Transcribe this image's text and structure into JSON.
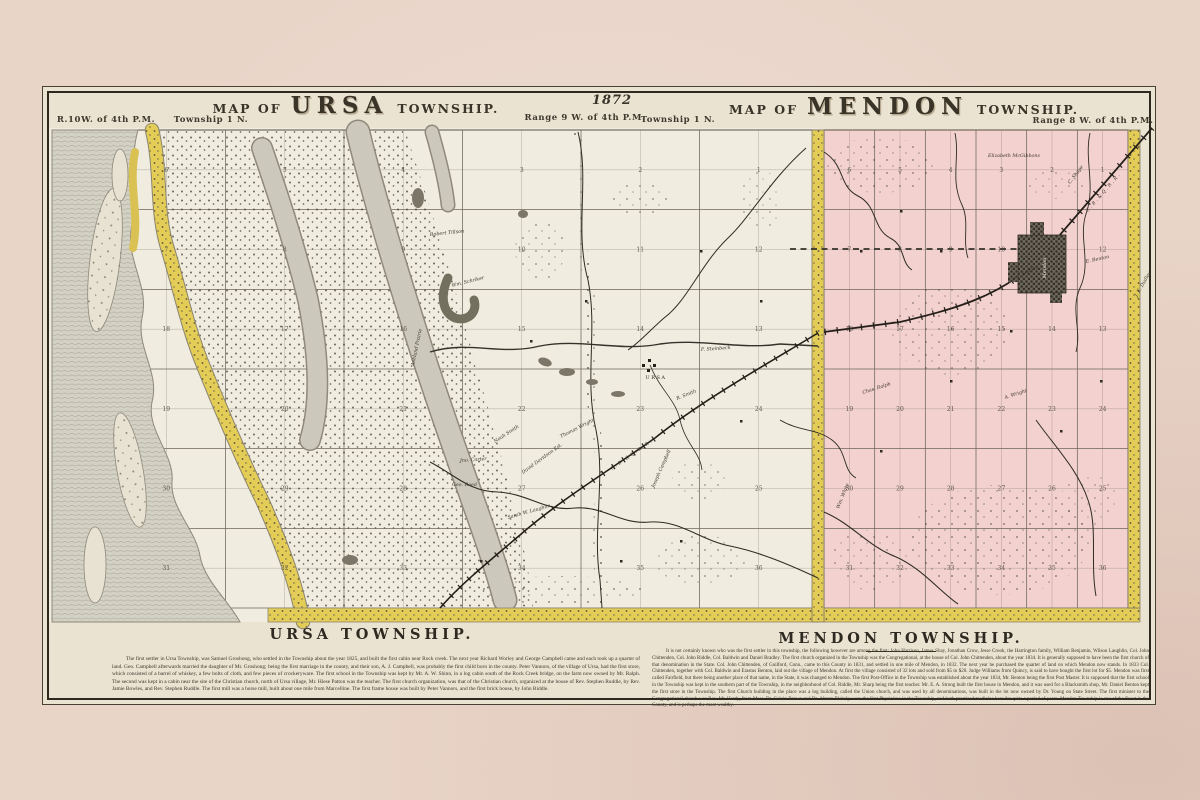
{
  "sheet": {
    "year": "1872",
    "ursa": {
      "map_title_prefix": "MAP OF",
      "map_title_name": "URSA",
      "map_title_suffix": "TOWNSHIP.",
      "meridian_label": "R.10W. of 4th P.M.",
      "township_label": "Township 1 N.",
      "range_label": "Range 9 W. of 4th P.M.",
      "footer_title": "URSA TOWNSHIP.",
      "history": "The first settler in Ursa Township, was Samuel Groshong, who settled in the Township about the year 1825, and built the first cabin near Rock creek. The next year Richard Worley and George Campbell came and each took up a quarter of land. Geo. Campbell afterwards married the daughter of Mr. Groshong; being the first marriage in the county, and their son, A. J. Campbell, was probably the first child born in the county. Peter Vannors, of the village of Ursa, had the first store, which consisted of a barrel of whiskey, a few bolts of cloth, and few pieces of crockeryware. The first school in the Township was kept by Mr. A. W. Shinn, in a log cabin south of the Rock Creek bridge, on the farm now owned by Mr. Ralph. The second was kept in a cabin near the site of the Christian church, north of Ursa village, Mr. Hiese Patton was the teacher. The first church organization, was that of the Christian church, organized at the house of Rev. Stephen Ruddle, by Rev. Jamie Bowles, and Rev. Stephen Ruddle. The first mill was a horse mill, built about one mile from Marcelline. The first frame house was built by Peter Vannors, and the first brick house, by John Riddle."
    },
    "mendon": {
      "map_title_prefix": "MAP OF",
      "map_title_name": "MENDON",
      "map_title_suffix": "TOWNSHIP.",
      "township_label": "Township 1 N.",
      "range_label": "Range 8 W. of 4th P.M.",
      "footer_title": "MENDON TOWNSHIP.",
      "history": "It is not certainly known who was the first settler in this township, the following however are among the first: John Harrison, James Shay, Jonathan Crow, Jesse Crook, the Harrington family, William Benjamin, Wilson Laughlin, Col. John Chittenden, Col. John Riddle, Col. Baldwin and Daniel Bradley. The first church organized in the Township was the Congregational, at the house of Col. John Chittenden, about the year 1834. It is generally supposed to have been the first church of that denomination in the State. Col. John Chittenden, of Guilford, Conn., came to this County in 1831, and settled in one mile of Mendon, in 1832. The next year he purchased the quarter of land on which Mendon now stands. In 1833 Col. Chittenden, together with Col. Baldwin and Erastus Benton, laid out the village of Mendon. At first the village consisted of 32 lots and sold from $5 to $20. Judge Williams from Quincy, is said to have bought the first lot for $5. Mendon was first called Fairfield, but there being another place of that name, in the State, it was changed to Mendon. The first Post-Office in the Township was established about the year 1834, Mr. Benton being the first Post Master. It is supposed that the first school in the Township was kept in the southern part of the Township, in the neighborhood of Col. Riddle, Mr. Sharp being the first teacher. Mr. E. A. Strong built the first house in Mendon, and it was used for a Blacksmith shop, Mr. Daniel Benton kept the first store in the Township. The first Church building in the place was a log building, called the Union church, and was used by all denominations, was built in the lot now owned by Dr. Young on State Street. The first minister to the Congregational church was Rev. Mr. Hardy, from Mass. Dr. Calvin Brown and Dr. Abram Blakely were the first Physicians in the Township, and both practiced medicine here for quite a period of years. Mendon Township is one of the finest in the County, and is perhaps the most wealthy."
    }
  },
  "map": {
    "ursa_sections": [
      "6",
      "5",
      "4",
      "3",
      "2",
      "1",
      "7",
      "8",
      "9",
      "10",
      "11",
      "12",
      "18",
      "17",
      "16",
      "15",
      "14",
      "13",
      "19",
      "20",
      "21",
      "22",
      "23",
      "24",
      "30",
      "29",
      "28",
      "27",
      "26",
      "25",
      "31",
      "32",
      "33",
      "34",
      "35",
      "36"
    ],
    "mendon_sections": [
      "6",
      "5",
      "4",
      "3",
      "2",
      "1",
      "7",
      "8",
      "9",
      "10",
      "11",
      "12",
      "18",
      "17",
      "16",
      "15",
      "14",
      "13",
      "19",
      "20",
      "21",
      "22",
      "23",
      "24",
      "30",
      "29",
      "28",
      "27",
      "26",
      "25",
      "31",
      "32",
      "33",
      "34",
      "35",
      "36"
    ],
    "ursa_labels": [
      {
        "t": "Robert Tillson",
        "x": 430,
        "y": 236,
        "r": -6
      },
      {
        "t": "Wm. Schriker",
        "x": 452,
        "y": 287,
        "r": -14
      },
      {
        "t": "Ashland Prairie",
        "x": 414,
        "y": 366,
        "r": -78,
        "s": 5.2
      },
      {
        "t": "Noah Smith",
        "x": 495,
        "y": 443,
        "r": -33
      },
      {
        "t": "Thomas Wright",
        "x": 561,
        "y": 438,
        "r": -27
      },
      {
        "t": "Jno. Carter",
        "x": 460,
        "y": 462,
        "r": -4
      },
      {
        "t": "Geo. Reed",
        "x": 452,
        "y": 486,
        "r": 0
      },
      {
        "t": "David Davidson Est.",
        "x": 523,
        "y": 474,
        "r": -36
      },
      {
        "t": "Joseph Campbell",
        "x": 654,
        "y": 488,
        "r": -66
      },
      {
        "t": "Sarah W. Laughlin",
        "x": 508,
        "y": 519,
        "r": -16
      },
      {
        "t": "F. Steinbeck",
        "x": 701,
        "y": 351,
        "r": -4
      },
      {
        "t": "R. Smith",
        "x": 677,
        "y": 400,
        "r": -22
      }
    ],
    "mendon_labels": [
      {
        "t": "Elizabeth McGibbons",
        "x": 988,
        "y": 157,
        "r": 0,
        "s": 4.6
      },
      {
        "t": "C. Shupe",
        "x": 1070,
        "y": 184,
        "r": -52
      },
      {
        "t": "Saml. Kenney",
        "x": 1009,
        "y": 283,
        "r": -28
      },
      {
        "t": "E. Benton",
        "x": 1086,
        "y": 263,
        "r": -12
      },
      {
        "t": "A. Wright",
        "x": 1005,
        "y": 399,
        "r": -18
      },
      {
        "t": "Chas. Ralph",
        "x": 863,
        "y": 394,
        "r": -18
      },
      {
        "t": "J. E. Dudley",
        "x": 1137,
        "y": 297,
        "r": -60
      },
      {
        "t": "Wm. White",
        "x": 839,
        "y": 509,
        "r": -68
      }
    ],
    "village_label": "URSA",
    "town_label": "Mendon",
    "railroad_label": "C.B.&Q.R.R."
  },
  "colors": {
    "paper": "#e9d4c8",
    "sheet": "#ebe3d2",
    "ursa-bg": "#f0ecdf",
    "mendon-pink": "#f3d1cf",
    "band-yellow": "#e4cd57",
    "river-gray": "#d3d0c4",
    "ink": "#35312a"
  }
}
